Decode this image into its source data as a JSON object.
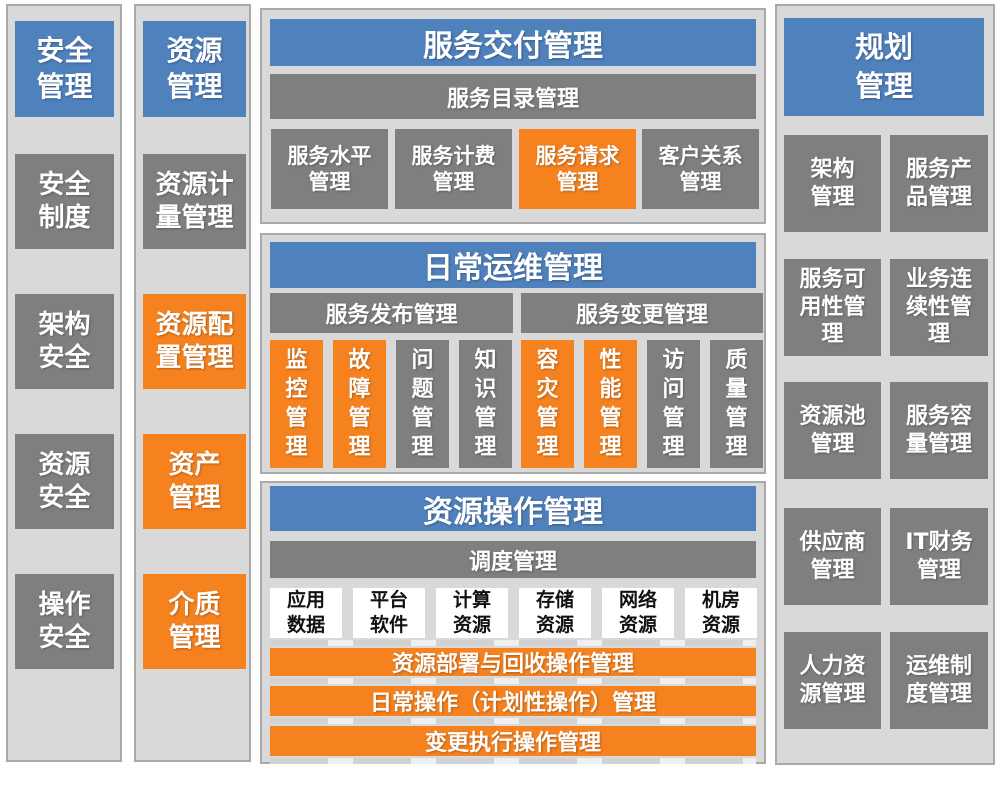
{
  "colors": {
    "blue": "#4F81BD",
    "orange": "#F5821F",
    "gray": "#7F7F7F",
    "panel_bg": "#D9D9D9",
    "panel_border": "#A9A9A9"
  },
  "security_column": {
    "header": {
      "label": "安全\n管理",
      "color": "blue"
    },
    "items": [
      {
        "label": "安全\n制度",
        "color": "gray"
      },
      {
        "label": "架构\n安全",
        "color": "gray"
      },
      {
        "label": "资源\n安全",
        "color": "gray"
      },
      {
        "label": "操作\n安全",
        "color": "gray"
      }
    ]
  },
  "resource_column": {
    "header": {
      "label": "资源\n管理",
      "color": "blue"
    },
    "items": [
      {
        "label": "资源计\n量管理",
        "color": "gray"
      },
      {
        "label": "资源配\n置管理",
        "color": "orange"
      },
      {
        "label": "资产\n管理",
        "color": "orange"
      },
      {
        "label": "介质\n管理",
        "color": "orange"
      }
    ]
  },
  "service_delivery": {
    "header": {
      "label": "服务交付管理",
      "color": "blue"
    },
    "catalog_bar": {
      "label": "服务目录管理",
      "color": "gray"
    },
    "items": [
      {
        "label": "服务水平\n管理",
        "color": "gray"
      },
      {
        "label": "服务计费\n管理",
        "color": "gray"
      },
      {
        "label": "服务请求\n管理",
        "color": "orange"
      },
      {
        "label": "客户关系\n管理",
        "color": "gray"
      }
    ]
  },
  "daily_operations": {
    "header": {
      "label": "日常运维管理",
      "color": "blue"
    },
    "release_bar": {
      "label": "服务发布管理",
      "color": "gray"
    },
    "change_bar": {
      "label": "服务变更管理",
      "color": "gray"
    },
    "items": [
      {
        "label": "监\n控\n管\n理",
        "color": "orange"
      },
      {
        "label": "故\n障\n管\n理",
        "color": "orange"
      },
      {
        "label": "问\n题\n管\n理",
        "color": "gray"
      },
      {
        "label": "知\n识\n管\n理",
        "color": "gray"
      },
      {
        "label": "容\n灾\n管\n理",
        "color": "orange"
      },
      {
        "label": "性\n能\n管\n理",
        "color": "orange"
      },
      {
        "label": "访\n问\n管\n理",
        "color": "gray"
      },
      {
        "label": "质\n量\n管\n理",
        "color": "gray"
      }
    ]
  },
  "resource_operations": {
    "header": {
      "label": "资源操作管理",
      "color": "blue"
    },
    "dispatch_bar": {
      "label": "调度管理",
      "color": "gray"
    },
    "resource_boxes": [
      {
        "label": "应用\n数据",
        "color": "white"
      },
      {
        "label": "平台\n软件",
        "color": "white"
      },
      {
        "label": "计算\n资源",
        "color": "white"
      },
      {
        "label": "存储\n资源",
        "color": "white"
      },
      {
        "label": "网络\n资源",
        "color": "white"
      },
      {
        "label": "机房\n资源",
        "color": "white"
      }
    ],
    "operation_bars": [
      {
        "label": "资源部署与回收操作管理",
        "color": "orange"
      },
      {
        "label": "日常操作（计划性操作）管理",
        "color": "orange"
      },
      {
        "label": "变更执行操作管理",
        "color": "orange"
      }
    ]
  },
  "planning_column": {
    "header": {
      "label": "规划\n管理",
      "color": "blue"
    },
    "items": [
      {
        "label": "架构\n管理",
        "color": "gray"
      },
      {
        "label": "服务产\n品管理",
        "color": "gray"
      },
      {
        "label": "服务可\n用性管\n理",
        "color": "gray"
      },
      {
        "label": "业务连\n续性管\n理",
        "color": "gray"
      },
      {
        "label": "资源池\n管理",
        "color": "gray"
      },
      {
        "label": "服务容\n量管理",
        "color": "gray"
      },
      {
        "label": "供应商\n管理",
        "color": "gray"
      },
      {
        "label": "IT财务\n管理",
        "color": "gray"
      },
      {
        "label": "人力资\n源管理",
        "color": "gray"
      },
      {
        "label": "运维制\n度管理",
        "color": "gray"
      }
    ]
  }
}
